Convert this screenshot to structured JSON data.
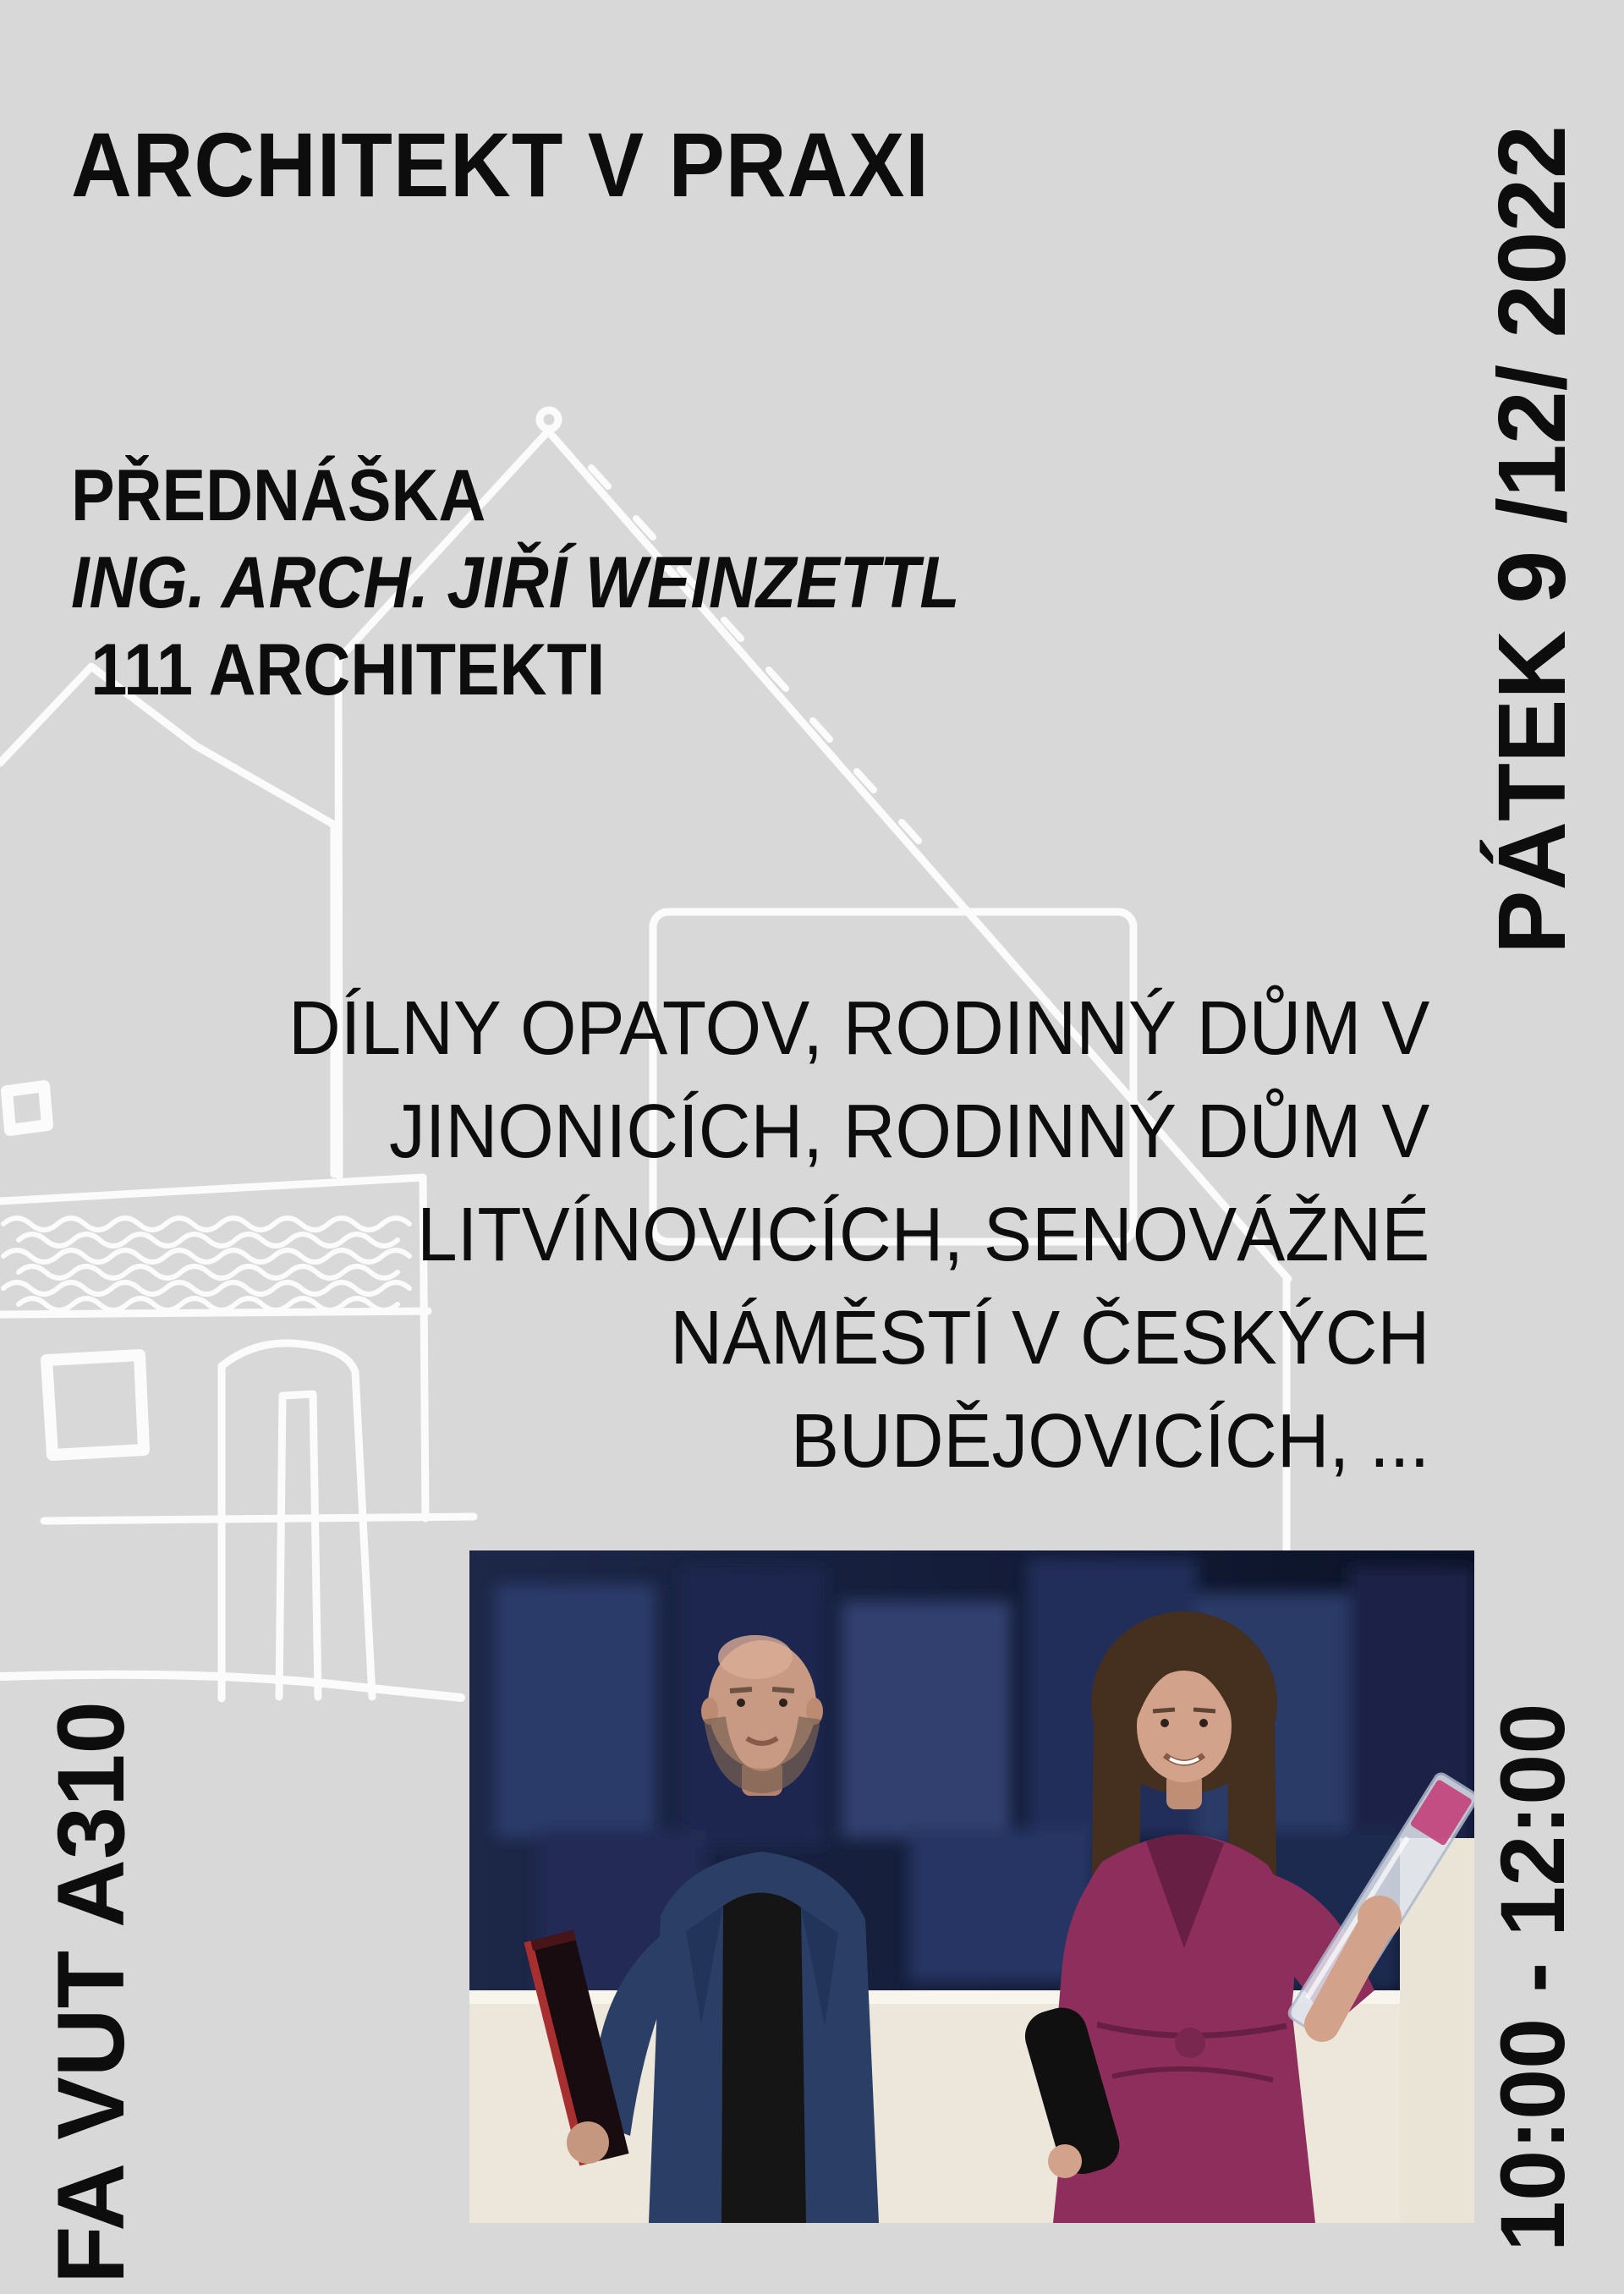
{
  "poster": {
    "title": "ARCHITEKT V PRAXI",
    "lecture": {
      "label": "PŘEDNÁŠKA",
      "speaker": "ING. ARCH. JIŘÍ WEINZETTL",
      "studio": "111 ARCHITEKTI"
    },
    "works": {
      "lines": [
        "DÍLNY OPATOV, RODINNÝ DŮM V",
        "JINONICÍCH, RODINNÝ DŮM V",
        "LITVÍNOVICÍCH, SENOVÁŽNÉ",
        "NÁMĚSTÍ V ČESKÝCH",
        "BUDĚJOVICÍCH, ..."
      ]
    },
    "date_vertical": "PÁTEK 9 /12/ 2022",
    "venue_vertical": "FA VUT A310",
    "time_vertical": "10:00 - 12:00",
    "photo": {
      "alt": "two-architects-holding-awards"
    },
    "colors": {
      "background": "#d8d8d8",
      "text": "#0d0d0d",
      "sketch": "#fbfbfb",
      "photo_backdrop": "#1d2748",
      "photo_wall": "#ece7da",
      "jacket": "#2b3f66",
      "dress": "#8e2e5c",
      "award_red": "#a82f2f",
      "award_label_pink": "#c2407a"
    }
  }
}
